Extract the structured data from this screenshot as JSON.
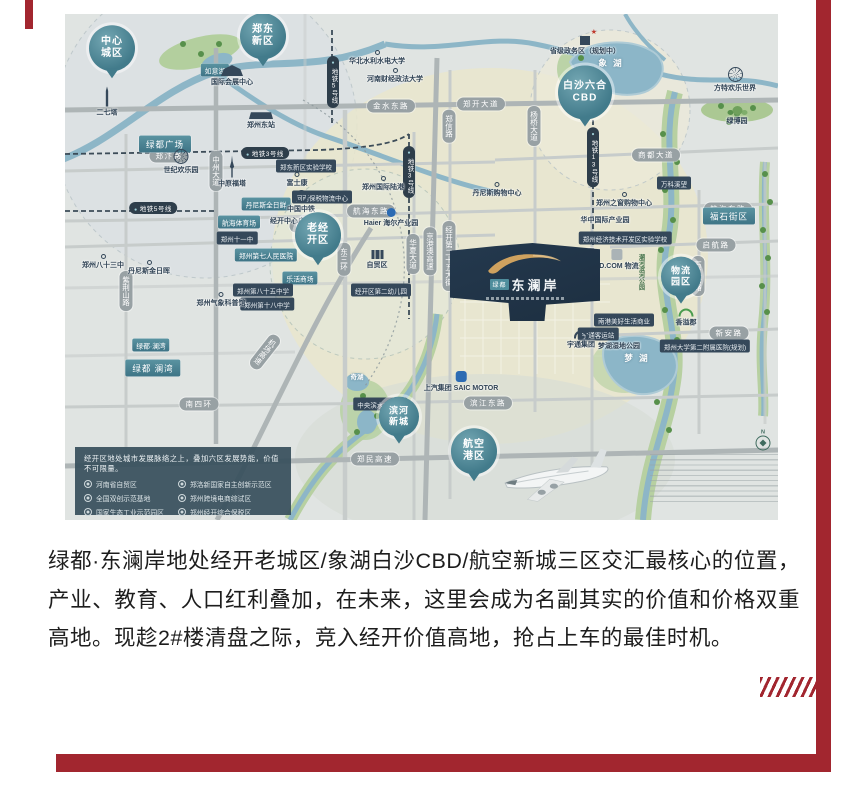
{
  "page": {
    "accent_red": "#A2262F",
    "map_base": "#e0e4e2"
  },
  "paragraph": {
    "text": "绿都·东澜岸地处经开老城区/象湖白沙CBD/航空新城三区交汇最核心的位置，产业、教育、人口红利叠加，在未来，这里会成为名副其实的价值和价格双重高地。现趁2#楼清盘之际，竞入经开价值高地，抢占上车的最佳时机。"
  },
  "map": {
    "project": {
      "brand": "绿都",
      "name": "东澜岸"
    },
    "compass_n": "N",
    "pins": [
      {
        "label": "中心\n城区",
        "x": 47,
        "y": 46
      },
      {
        "label": "郑东\n新区",
        "x": 198,
        "y": 34
      },
      {
        "label": "白沙六合\nCBD",
        "x": 520,
        "y": 91,
        "cls": "big"
      },
      {
        "label": "老经\n开区",
        "x": 253,
        "y": 233
      },
      {
        "label": "物流\n园区",
        "x": 616,
        "y": 274,
        "cls": "small"
      },
      {
        "label": "滨河\n新城",
        "x": 334,
        "y": 414,
        "cls": "small"
      },
      {
        "label": "航空\n港区",
        "x": 409,
        "y": 449
      }
    ],
    "road_labels": [
      {
        "label": "郑汴路",
        "x": 104,
        "y": 142
      },
      {
        "label": "金水东路",
        "x": 326,
        "y": 92
      },
      {
        "label": "郑开大道",
        "x": 416,
        "y": 90
      },
      {
        "label": "商都大道",
        "x": 591,
        "y": 141
      },
      {
        "label": "航海东路",
        "x": 306,
        "y": 197
      },
      {
        "label": "航海东路",
        "x": 663,
        "y": 195
      },
      {
        "label": "南三环",
        "x": 244,
        "y": 212
      },
      {
        "label": "启航路",
        "x": 651,
        "y": 231
      },
      {
        "label": "新安路",
        "x": 664,
        "y": 319
      },
      {
        "label": "南四环",
        "x": 134,
        "y": 390
      },
      {
        "label": "滨江东路",
        "x": 423,
        "y": 389
      },
      {
        "label": "郑民高速",
        "x": 310,
        "y": 445
      },
      {
        "label": "中州大道",
        "x": 151,
        "y": 157,
        "cls": "v"
      },
      {
        "label": "紫荆山路",
        "x": 61,
        "y": 277,
        "cls": "v"
      },
      {
        "label": "东三环",
        "x": 279,
        "y": 245,
        "cls": "v"
      },
      {
        "label": "华夏大道",
        "x": 348,
        "y": 240,
        "cls": "v"
      },
      {
        "label": "京港澳高速",
        "x": 365,
        "y": 237,
        "cls": "v"
      },
      {
        "label": "经开第二十五大街",
        "x": 384,
        "y": 242,
        "cls": "v"
      },
      {
        "label": "杨桥大道",
        "x": 469,
        "y": 112,
        "cls": "v"
      },
      {
        "label": "郑信路",
        "x": 384,
        "y": 112,
        "cls": "v"
      },
      {
        "label": "前程大道",
        "x": 526,
        "y": 254,
        "cls": "v"
      },
      {
        "label": "万三公路",
        "x": 633,
        "y": 262,
        "cls": "v"
      },
      {
        "label": "机场高速",
        "x": 200,
        "y": 338,
        "cls": "v diag"
      }
    ],
    "metro_labels": [
      {
        "label": "地铁5号线",
        "x": 268,
        "y": 68,
        "cls": "v"
      },
      {
        "label": "地铁3号线",
        "x": 200,
        "y": 139
      },
      {
        "label": "地铁5号线",
        "x": 88,
        "y": 194
      },
      {
        "label": "地铁3号线",
        "x": 344,
        "y": 158,
        "cls": "v"
      },
      {
        "label": "地铁13号线",
        "x": 528,
        "y": 143,
        "cls": "v"
      }
    ],
    "poi_teal": [
      {
        "label": "绿都广场",
        "x": 100,
        "y": 130,
        "cls": "lg"
      },
      {
        "label": "如意湖",
        "x": 150,
        "y": 56
      },
      {
        "label": "航海体育场",
        "x": 174,
        "y": 208
      },
      {
        "label": "郑州第七人民医院",
        "x": 201,
        "y": 241
      },
      {
        "label": "乐活商场",
        "x": 235,
        "y": 264
      },
      {
        "label": "丹尼斯全日鲜",
        "x": 201,
        "y": 190
      },
      {
        "label": "福石街区",
        "x": 664,
        "y": 202,
        "cls": "lg"
      },
      {
        "label": "绿都·澜湾",
        "x": 86,
        "y": 331
      },
      {
        "label": "绿都 澜湾",
        "x": 88,
        "y": 354,
        "cls": "lg"
      }
    ],
    "poi_dark": [
      {
        "label": "郑东新区实验学校",
        "x": 241,
        "y": 152
      },
      {
        "label": "河南保税物流中心",
        "x": 257,
        "y": 183
      },
      {
        "label": "郑州十一中",
        "x": 172,
        "y": 224
      },
      {
        "label": "郑州第八十五中学",
        "x": 198,
        "y": 276
      },
      {
        "label": "郑州第十八中学",
        "x": 202,
        "y": 290
      },
      {
        "label": "经开区第二幼儿园",
        "x": 316,
        "y": 276
      },
      {
        "label": "郑州经济技术开发区实验学校",
        "x": 560,
        "y": 224
      },
      {
        "label": "南港美好生活商业",
        "x": 559,
        "y": 306
      },
      {
        "label": "宇通客运站",
        "x": 533,
        "y": 320
      },
      {
        "label": "中央滨水商业区",
        "x": 315,
        "y": 390
      },
      {
        "label": "郑州大学第二附属医院(规划)",
        "x": 640,
        "y": 332
      },
      {
        "label": "万科溪望",
        "x": 609,
        "y": 169
      }
    ],
    "landmarks": [
      {
        "icon": "tower",
        "label": "二七塔",
        "x": 42,
        "y": 88
      },
      {
        "icon": "expo",
        "label": "国际会展中心",
        "x": 167,
        "y": 62
      },
      {
        "icon": "ferris",
        "label": "世纪欢乐园",
        "x": 116,
        "y": 148
      },
      {
        "icon": "tower2",
        "label": "中原福塔",
        "x": 167,
        "y": 158
      },
      {
        "icon": "station",
        "label": "郑州东站",
        "x": 196,
        "y": 106
      },
      {
        "icon": "ferris",
        "label": "方特欢乐世界",
        "x": 670,
        "y": 66
      },
      {
        "icon": "trees",
        "label": "绿博园",
        "x": 672,
        "y": 102
      },
      {
        "icon": "roundel",
        "label": "中国中铁",
        "x": 236,
        "y": 188
      },
      {
        "icon": "saic",
        "label": "上汽集团 SAIC MOTOR",
        "x": 396,
        "y": 368
      },
      {
        "icon": "jd",
        "label": "JD.COM 物流",
        "x": 552,
        "y": 246
      },
      {
        "icon": "yutong",
        "label": "宇通集团",
        "x": 516,
        "y": 326
      },
      {
        "icon": "univ",
        "label": "华北水利水电大学",
        "x": 312,
        "y": 44
      },
      {
        "icon": "univ",
        "label": "河南财经政法大学",
        "x": 330,
        "y": 62
      },
      {
        "icon": "dot",
        "label": "郑州气象科普馆",
        "x": 156,
        "y": 286
      },
      {
        "icon": "dot",
        "label": "郑州八十三中",
        "x": 38,
        "y": 248
      },
      {
        "icon": "dot",
        "label": "富士康",
        "x": 232,
        "y": 166
      },
      {
        "icon": "dot",
        "label": "郑州国际陆港",
        "x": 318,
        "y": 170
      },
      {
        "icon": "dot",
        "label": "丹尼斯购物中心",
        "x": 432,
        "y": 176
      },
      {
        "icon": "dot",
        "label": "丹尼斯金日晖",
        "x": 84,
        "y": 254
      },
      {
        "icon": "gov",
        "label": "省级政务区（规划中）",
        "x": 520,
        "y": 32
      },
      {
        "icon": "haier",
        "label": "Haier 海尔产业园",
        "x": 326,
        "y": 204
      },
      {
        "icon": "none",
        "label": "经开中心广场",
        "x": 226,
        "y": 207
      },
      {
        "icon": "bld",
        "label": "自贸区",
        "x": 312,
        "y": 246
      },
      {
        "icon": "rainbow",
        "label": "香溢郡",
        "x": 621,
        "y": 304
      },
      {
        "icon": "none",
        "label": "梦湖湿地公园",
        "x": 554,
        "y": 332
      },
      {
        "icon": "none",
        "label": "华中国际产业园",
        "x": 540,
        "y": 206
      },
      {
        "icon": "dot",
        "label": "郑州之窗购物中心",
        "x": 559,
        "y": 186
      }
    ],
    "lakes": [
      {
        "label": "象 湖",
        "x": 546,
        "y": 49
      },
      {
        "label": "梦 湖",
        "x": 572,
        "y": 344
      },
      {
        "label": "奇湖",
        "x": 292,
        "y": 362,
        "cls": "sm"
      },
      {
        "label": "潮河滨河公园",
        "x": 576,
        "y": 258,
        "cls": "v grn"
      },
      {
        "label": "潮 河",
        "x": 482,
        "y": 254,
        "cls": "v sm"
      }
    ],
    "legend": {
      "title": "经开区地处城市发展脉络之上，叠加六区发展势能，价值不可限量。",
      "left": [
        "河南省自贸区",
        "全国双创示范基地",
        "国家生态工业示范园区"
      ],
      "right": [
        "郑洛新国家自主创新示范区",
        "郑州跨境电商综试区",
        "郑州经开综合保税区"
      ]
    }
  }
}
